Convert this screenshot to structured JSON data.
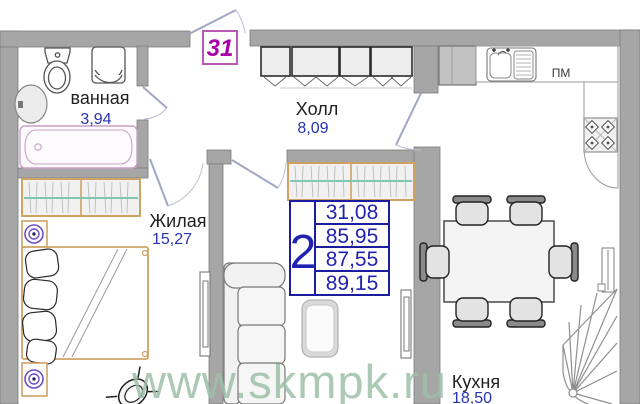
{
  "plan": {
    "apartment_number": "31",
    "watermark": "www.skmpk.ru",
    "rooms": {
      "bathroom": {
        "label": "ванная",
        "area": "3,94"
      },
      "hall": {
        "label": "Холл",
        "area": "8,09"
      },
      "living": {
        "label": "Жилая",
        "area": "15,27"
      },
      "kitchen": {
        "label": "Кухня",
        "area": "18,50"
      }
    },
    "appliances": {
      "dishwasher_label": "ПМ"
    },
    "area_table": {
      "rooms_count": "2",
      "values": [
        "31,08",
        "85,95",
        "87,55",
        "89,15"
      ]
    },
    "colors": {
      "wall_gray": "#a6a6a6",
      "area_blue": "#2222b2",
      "badge_purple": "#a800a8",
      "badge_border": "#b65ab6",
      "watermark_green": "#9dc0a8",
      "furniture_tan": "#cfa265",
      "rail_teal": "#7fc8b4",
      "lamp_purple": "#6e4fc6",
      "bath_pink": "#c9a0c9"
    }
  }
}
